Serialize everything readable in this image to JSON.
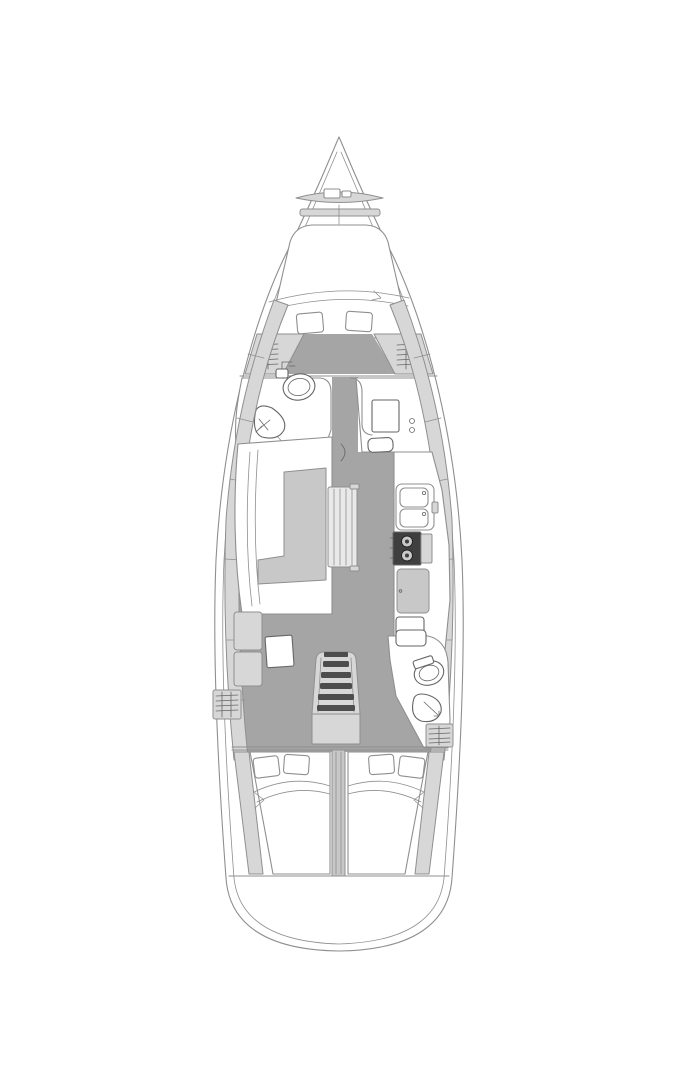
{
  "diagram": {
    "type": "sailboat-interior-floor-plan",
    "view": "top-down",
    "orientation": "bow-up"
  },
  "colors": {
    "background": "#ffffff",
    "outline": "#8f8f8f",
    "outline_dark": "#666666",
    "floor_gray": "#a5a5a5",
    "furniture_light": "#d7d7d7",
    "furniture_mid": "#c8c8c8",
    "fixture_white": "#ffffff",
    "stove_black": "#3f3f3f",
    "tread_dark": "#4d4d4d"
  },
  "areas": [
    {
      "name": "anchor-locker"
    },
    {
      "name": "forward-cabin"
    },
    {
      "name": "forward-head"
    },
    {
      "name": "nav-desk-area"
    },
    {
      "name": "salon"
    },
    {
      "name": "galley"
    },
    {
      "name": "companionway"
    },
    {
      "name": "aft-head"
    },
    {
      "name": "aft-cabin-port"
    },
    {
      "name": "aft-cabin-starboard"
    },
    {
      "name": "transom"
    }
  ],
  "fixtures": [
    "v-berth",
    "pillow",
    "hanging-locker",
    "toilet",
    "washbasin",
    "chart-desk",
    "l-settee",
    "saloon-table",
    "folding-table-leaf",
    "double-sink",
    "two-burner-stove",
    "refrigerator",
    "oven-locker",
    "companionway-steps",
    "engine-box",
    "double-berth",
    "swim-platform"
  ]
}
